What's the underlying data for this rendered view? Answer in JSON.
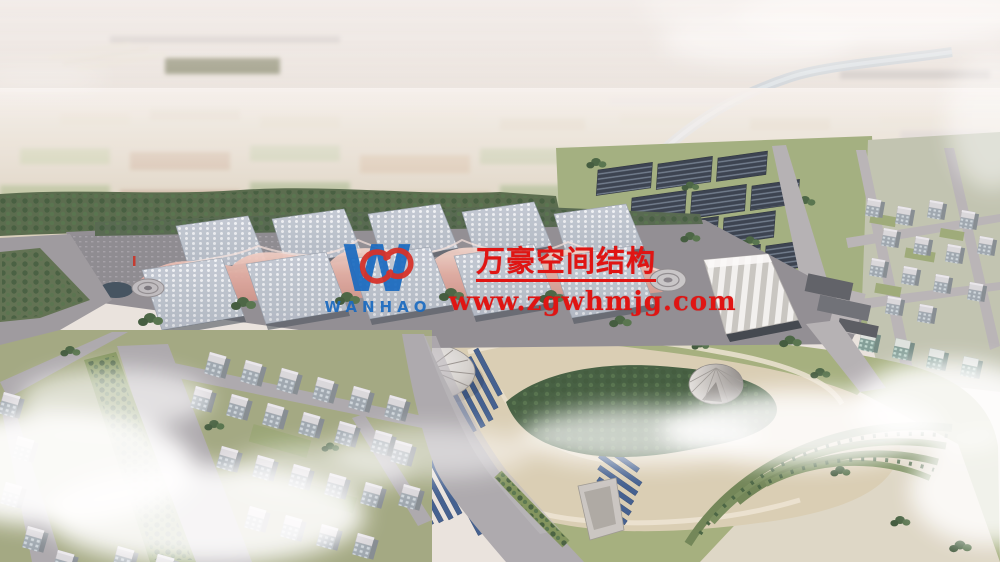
{
  "watermark": {
    "company_name_cn": "万豪空间结构",
    "website": "www.zgwhmjg.com",
    "logo_letter": "W",
    "logo_text": "WANHAO",
    "text_color": "#e01513",
    "logo_blue": "#1a6abf",
    "logo_red": "#d6322a"
  },
  "scene": {
    "palette": {
      "sky_haze": "#ebe5e0",
      "farmland": "#d7cdb8",
      "tree_green": "#55684a",
      "road_gray": "#a9a6aa",
      "hall_roof": "#c6cdd6",
      "membrane_pink": "#e3aba0",
      "solar_panel_dark": "#333b49",
      "park_sand": "#d9cdb2",
      "park_grass": "#a2ad7a",
      "park_panel_blue": "#3b5a8c",
      "river": "#c9d2d8",
      "cloud": "#ffffff"
    }
  }
}
